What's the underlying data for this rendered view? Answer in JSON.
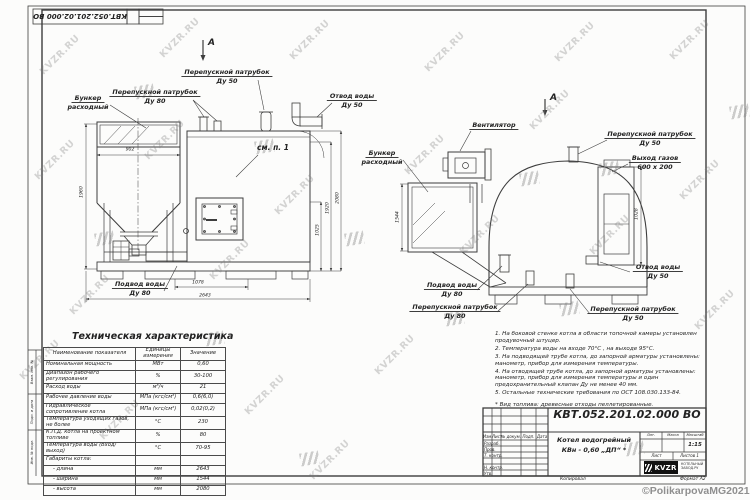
{
  "sheet": {
    "watermark_text": "KVZR.RU",
    "copyright": "©PolikarpovaMG2021"
  },
  "front_view": {
    "section_marker": "А",
    "labels": {
      "hopper": [
        "Бункер",
        "расходный"
      ],
      "bypass80": [
        "Перепускной патрубок",
        "Ду 80"
      ],
      "bypass50": [
        "Перепускной патрубок",
        "Ду 50"
      ],
      "outlet50": [
        "Отвод воды",
        "Ду 50"
      ],
      "see_note": "см. п. 1",
      "inlet80": [
        "Подвод воды",
        "Ду 80"
      ]
    },
    "dims": {
      "hopper_width": "902",
      "hopper_height": "1960",
      "h1": "1025",
      "h2": "1920",
      "h3": "2080",
      "w1": "1078",
      "w2": "2643"
    }
  },
  "side_view": {
    "view_marker": "А",
    "labels": {
      "fan": "Вентилятор",
      "hopper": [
        "Бункер",
        "расходный"
      ],
      "bypass50_top": [
        "Перепускной патрубок",
        "Ду 50"
      ],
      "gas_outlet": [
        "Выход газов",
        "600 х 200"
      ],
      "outlet50": [
        "Отвод воды",
        "Ду 50"
      ],
      "bypass50_bottom": [
        "Перепускной патрубок",
        "Ду 50"
      ],
      "inlet80": [
        "Подвод воды",
        "Ду 80"
      ],
      "bypass80": [
        "Перепускной патрубок",
        "Ду 80"
      ]
    },
    "dims": {
      "width": "1544",
      "gas_height": "1028"
    }
  },
  "spec_table": {
    "title": "Техническая характеристика",
    "headers": [
      "Наименование показателя",
      "Единицы измерения",
      "Значение"
    ],
    "rows": [
      [
        "Номинальная мощность",
        "МВт",
        "0,60"
      ],
      [
        "Диапазон рабочего регулирования",
        "%",
        "30-100"
      ],
      [
        "Расход воды",
        "м³/ч",
        "21"
      ],
      [
        "Рабочее давление воды",
        "МПа (кгс/см²)",
        "0,6(6,0)"
      ],
      [
        "Гидравлическое сопротивление котла",
        "МПа (кгс/см²)",
        "0,02(0,2)"
      ],
      [
        "Температура уходящих газов, не более",
        "°С",
        "230"
      ],
      [
        "К.П.Д. котла на проектном топливе",
        "%",
        "80"
      ],
      [
        "Температура воды (Вход/выход)",
        "°С",
        "70-95"
      ],
      [
        "Габариты котла:",
        "",
        ""
      ],
      [
        "- длина",
        "мм",
        "2643"
      ],
      [
        "- ширина",
        "мм",
        "1544"
      ],
      [
        "- высота",
        "мм",
        "2080"
      ]
    ]
  },
  "notes": {
    "items": [
      "1.  На боковой стенке котла в области топочной камеры установлен продувочный штуцер.",
      "2.  Температура воды на входе  70°С , на выходе  95°С.",
      "3.  На подводящей трубе котла, до запорной арматуры установлены: манометр, прибор для измерения температуры.",
      "4.  На отводящей трубе котла, до запорной арматуры установлены: манометр, прибор для измерения температуры и один предохранительный клапан Ду не менее 40 мм.",
      "5.  Остальные технические требования по ОСТ  108.030.133-84."
    ],
    "fuel": "*  Вид топлива:  древесные отходы пеллетированные."
  },
  "title_block": {
    "doc_number": "КВТ.052.201.02.000  ВО",
    "name_line1": "Котел водогрейный",
    "name_line2": "КВн - 0,60  „ДП“ *",
    "header_cells": [
      "Изм.",
      "Лист",
      "№ докум.",
      "Подп.",
      "Дата"
    ],
    "sign_rows": [
      "Разраб.",
      "Пров.",
      "Т. контр.",
      "Н. контр.",
      "Утв."
    ],
    "lit_label": "Лит.",
    "mass_label": "Масса",
    "scale_label": "Масштаб",
    "scale_value": "1:15",
    "sheet_label": "Лист",
    "sheets_label": "Листов 1",
    "company": "KVZR",
    "company_sub1": "КОТЕЛЬНЫЙ",
    "company_sub2": "ЗАВОД.РУ",
    "copied_label": "Копировал",
    "format_label": "Формат А2"
  },
  "margin": {
    "labels": [
      "Взам. инв. №",
      "Подп. и дата",
      "Инв. № подл."
    ]
  }
}
